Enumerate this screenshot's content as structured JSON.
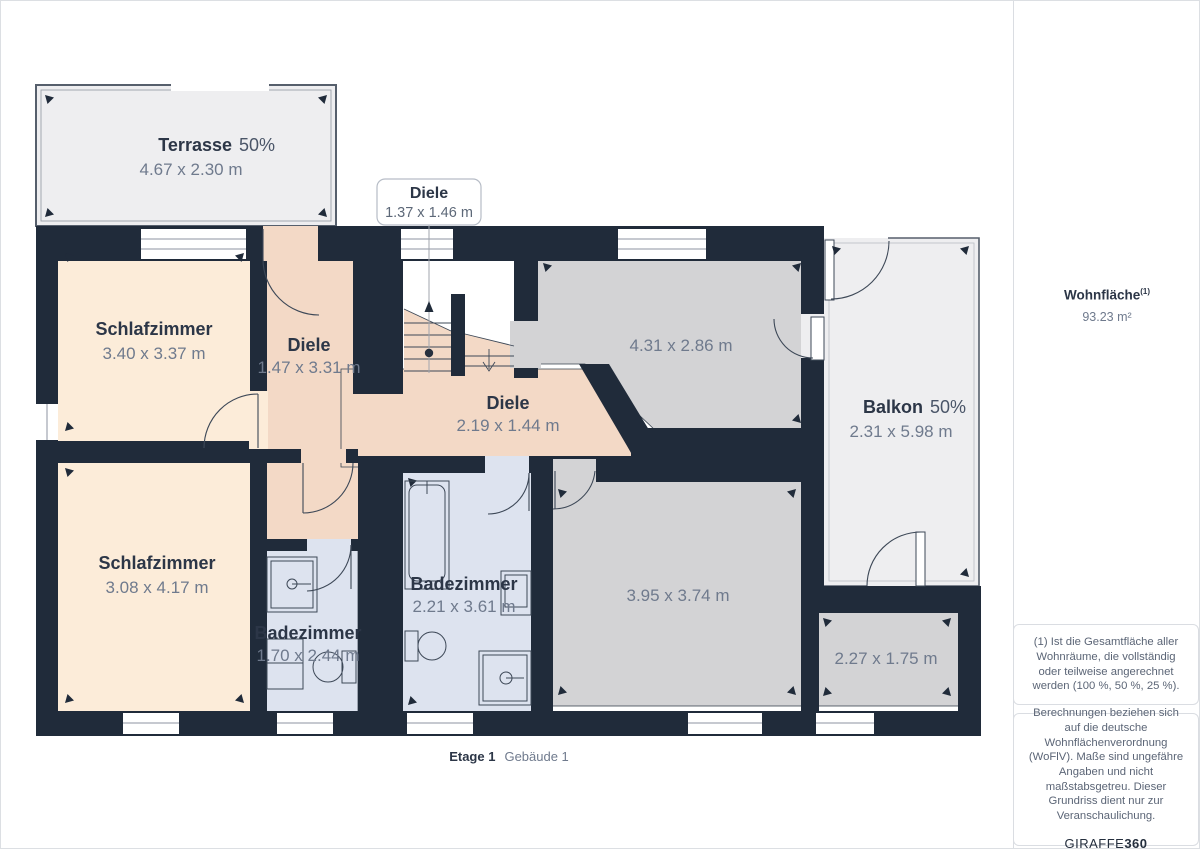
{
  "rooms": {
    "terrasse": {
      "name": "Terrasse",
      "percent": "50%",
      "dims": "4.67 x 2.30 m"
    },
    "diele_callout": {
      "name": "Diele",
      "dims": "1.37 x 1.46 m"
    },
    "schlafzimmer_1": {
      "name": "Schlafzimmer",
      "dims": "3.40 x 3.37 m"
    },
    "diele_1": {
      "name": "Diele",
      "dims": "1.47 x 3.31 m"
    },
    "diele_2": {
      "name": "Diele",
      "dims": "2.19 x 1.44 m"
    },
    "zimmer_1": {
      "dims": "4.31 x 2.86 m"
    },
    "balkon": {
      "name": "Balkon",
      "percent": "50%",
      "dims": "2.31 x 5.98 m"
    },
    "schlafzimmer_2": {
      "name": "Schlafzimmer",
      "dims": "3.08 x 4.17 m"
    },
    "badezimmer_1": {
      "name": "Badezimmer",
      "dims": "1.70 x 2.44 m"
    },
    "badezimmer_2": {
      "name": "Badezimmer",
      "dims": "2.21 x 3.61 m"
    },
    "zimmer_2": {
      "dims": "3.95 x 3.74 m"
    },
    "zimmer_3": {
      "dims": "2.27 x 1.75 m"
    }
  },
  "caption": {
    "floor": "Etage 1",
    "building": "Gebäude 1"
  },
  "sidebar": {
    "area_label": "Wohnfläche",
    "area_sup": "(1)",
    "area_value": "93.23 m²",
    "footnote1": "(1) Ist die Gesamtfläche aller Wohnräume, die vollständig oder teilweise angerechnet werden (100 %, 50 %, 25 %).",
    "footnote2": "Berechnungen beziehen sich auf die deutsche Wohnflächenverordnung (WoFlV). Maße sind ungefähre Angaben und nicht maßstabsgetreu. Dieser Grundriss dient nur zur Veranschaulichung.",
    "logo_prefix": "GIRAFFE",
    "logo_suffix": "360"
  },
  "colors": {
    "wall": "#202b3a",
    "bedroom": "#fcecd9",
    "hall": "#f3d9c6",
    "room_gray": "#d3d3d5",
    "bath": "#dde3ef",
    "open_area": "#eeeef0"
  }
}
